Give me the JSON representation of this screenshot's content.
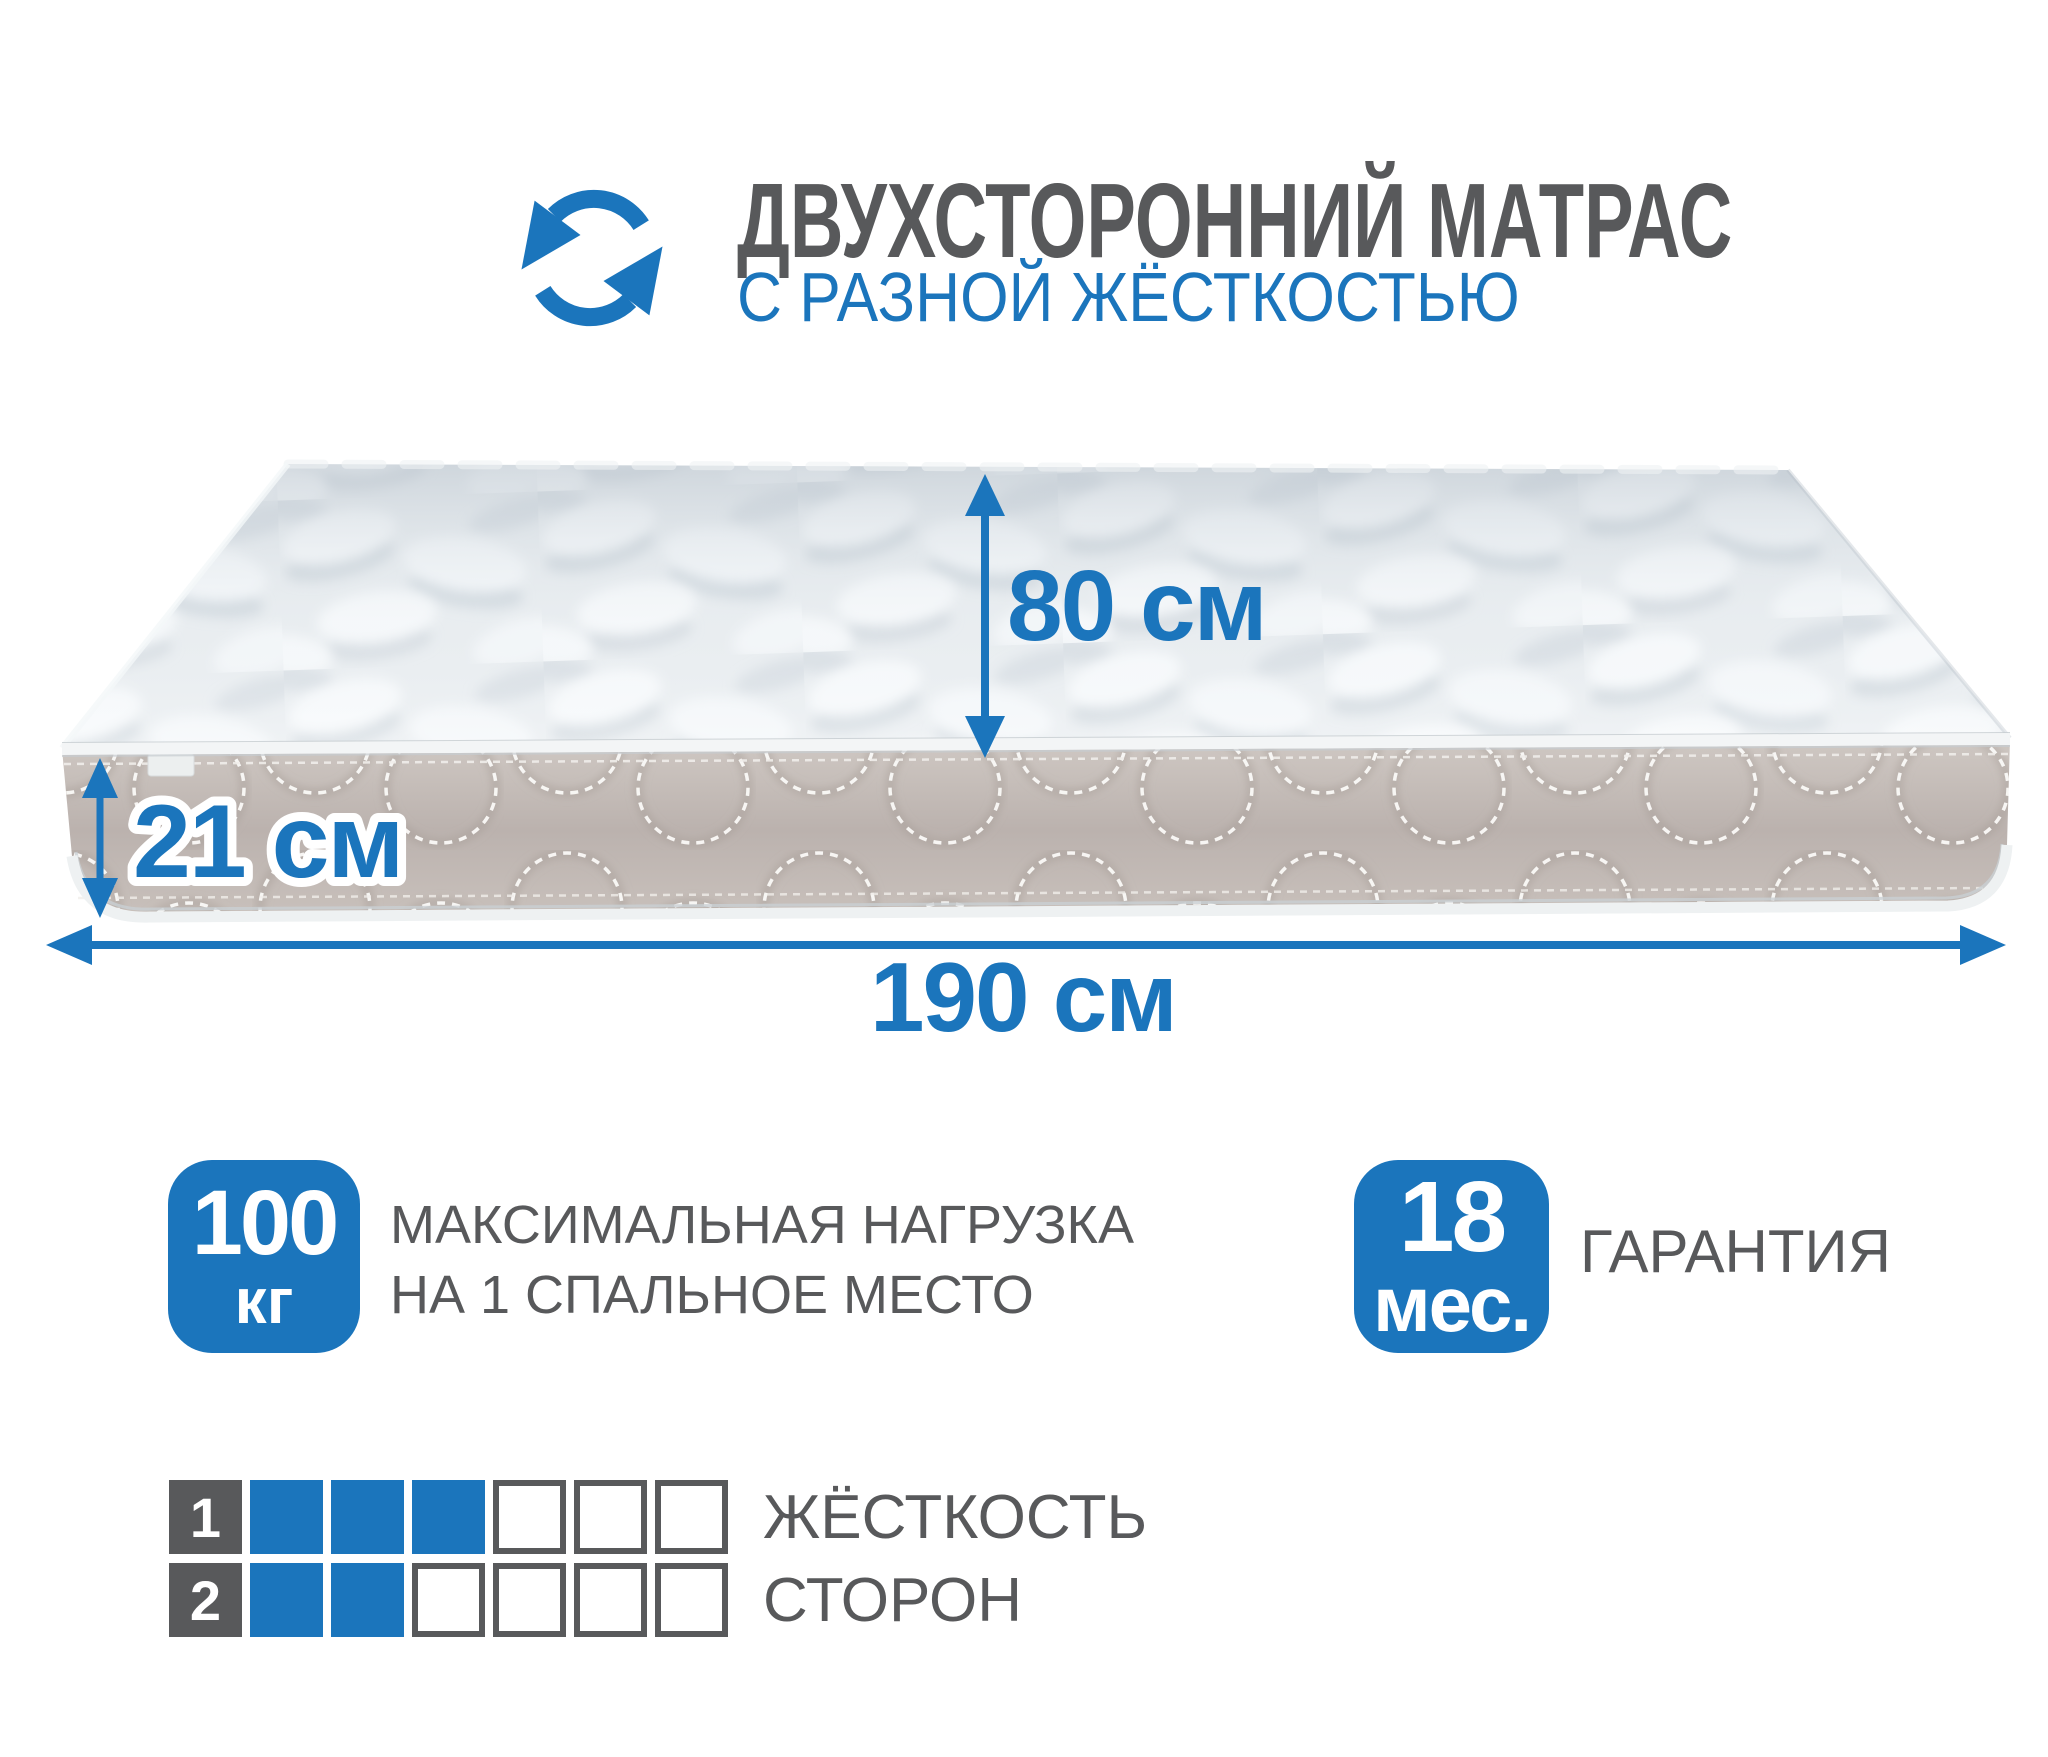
{
  "header": {
    "icon": "rotate-arrows-icon",
    "title": "ДВУХСТОРОННИЙ МАТРАС",
    "subtitle": "С РАЗНОЙ ЖЁСТКОСТЬЮ"
  },
  "dimensions": {
    "width_label": "80 см",
    "thickness_label": "21 см",
    "length_label": "190 см"
  },
  "badges": {
    "max_load": {
      "value": "100",
      "unit": "кг",
      "label_line1": "МАКСИМАЛЬНАЯ НАГРУЗКА",
      "label_line2": "НА 1 СПАЛЬНОЕ МЕСТО"
    },
    "warranty": {
      "value": "18",
      "unit": "мес.",
      "label": "ГАРАНТИЯ"
    }
  },
  "firmness_scale": {
    "label_line1": "ЖЁСТКОСТЬ",
    "label_line2": "СТОРОН",
    "max": 6,
    "rows": [
      {
        "index": "1",
        "filled": 3
      },
      {
        "index": "2",
        "filled": 2
      }
    ]
  },
  "colors": {
    "accent_blue": "#1B75BC",
    "text_gray": "#58595B",
    "side_band": "#BFB6B1",
    "top_surface": "#E9EDF0"
  }
}
